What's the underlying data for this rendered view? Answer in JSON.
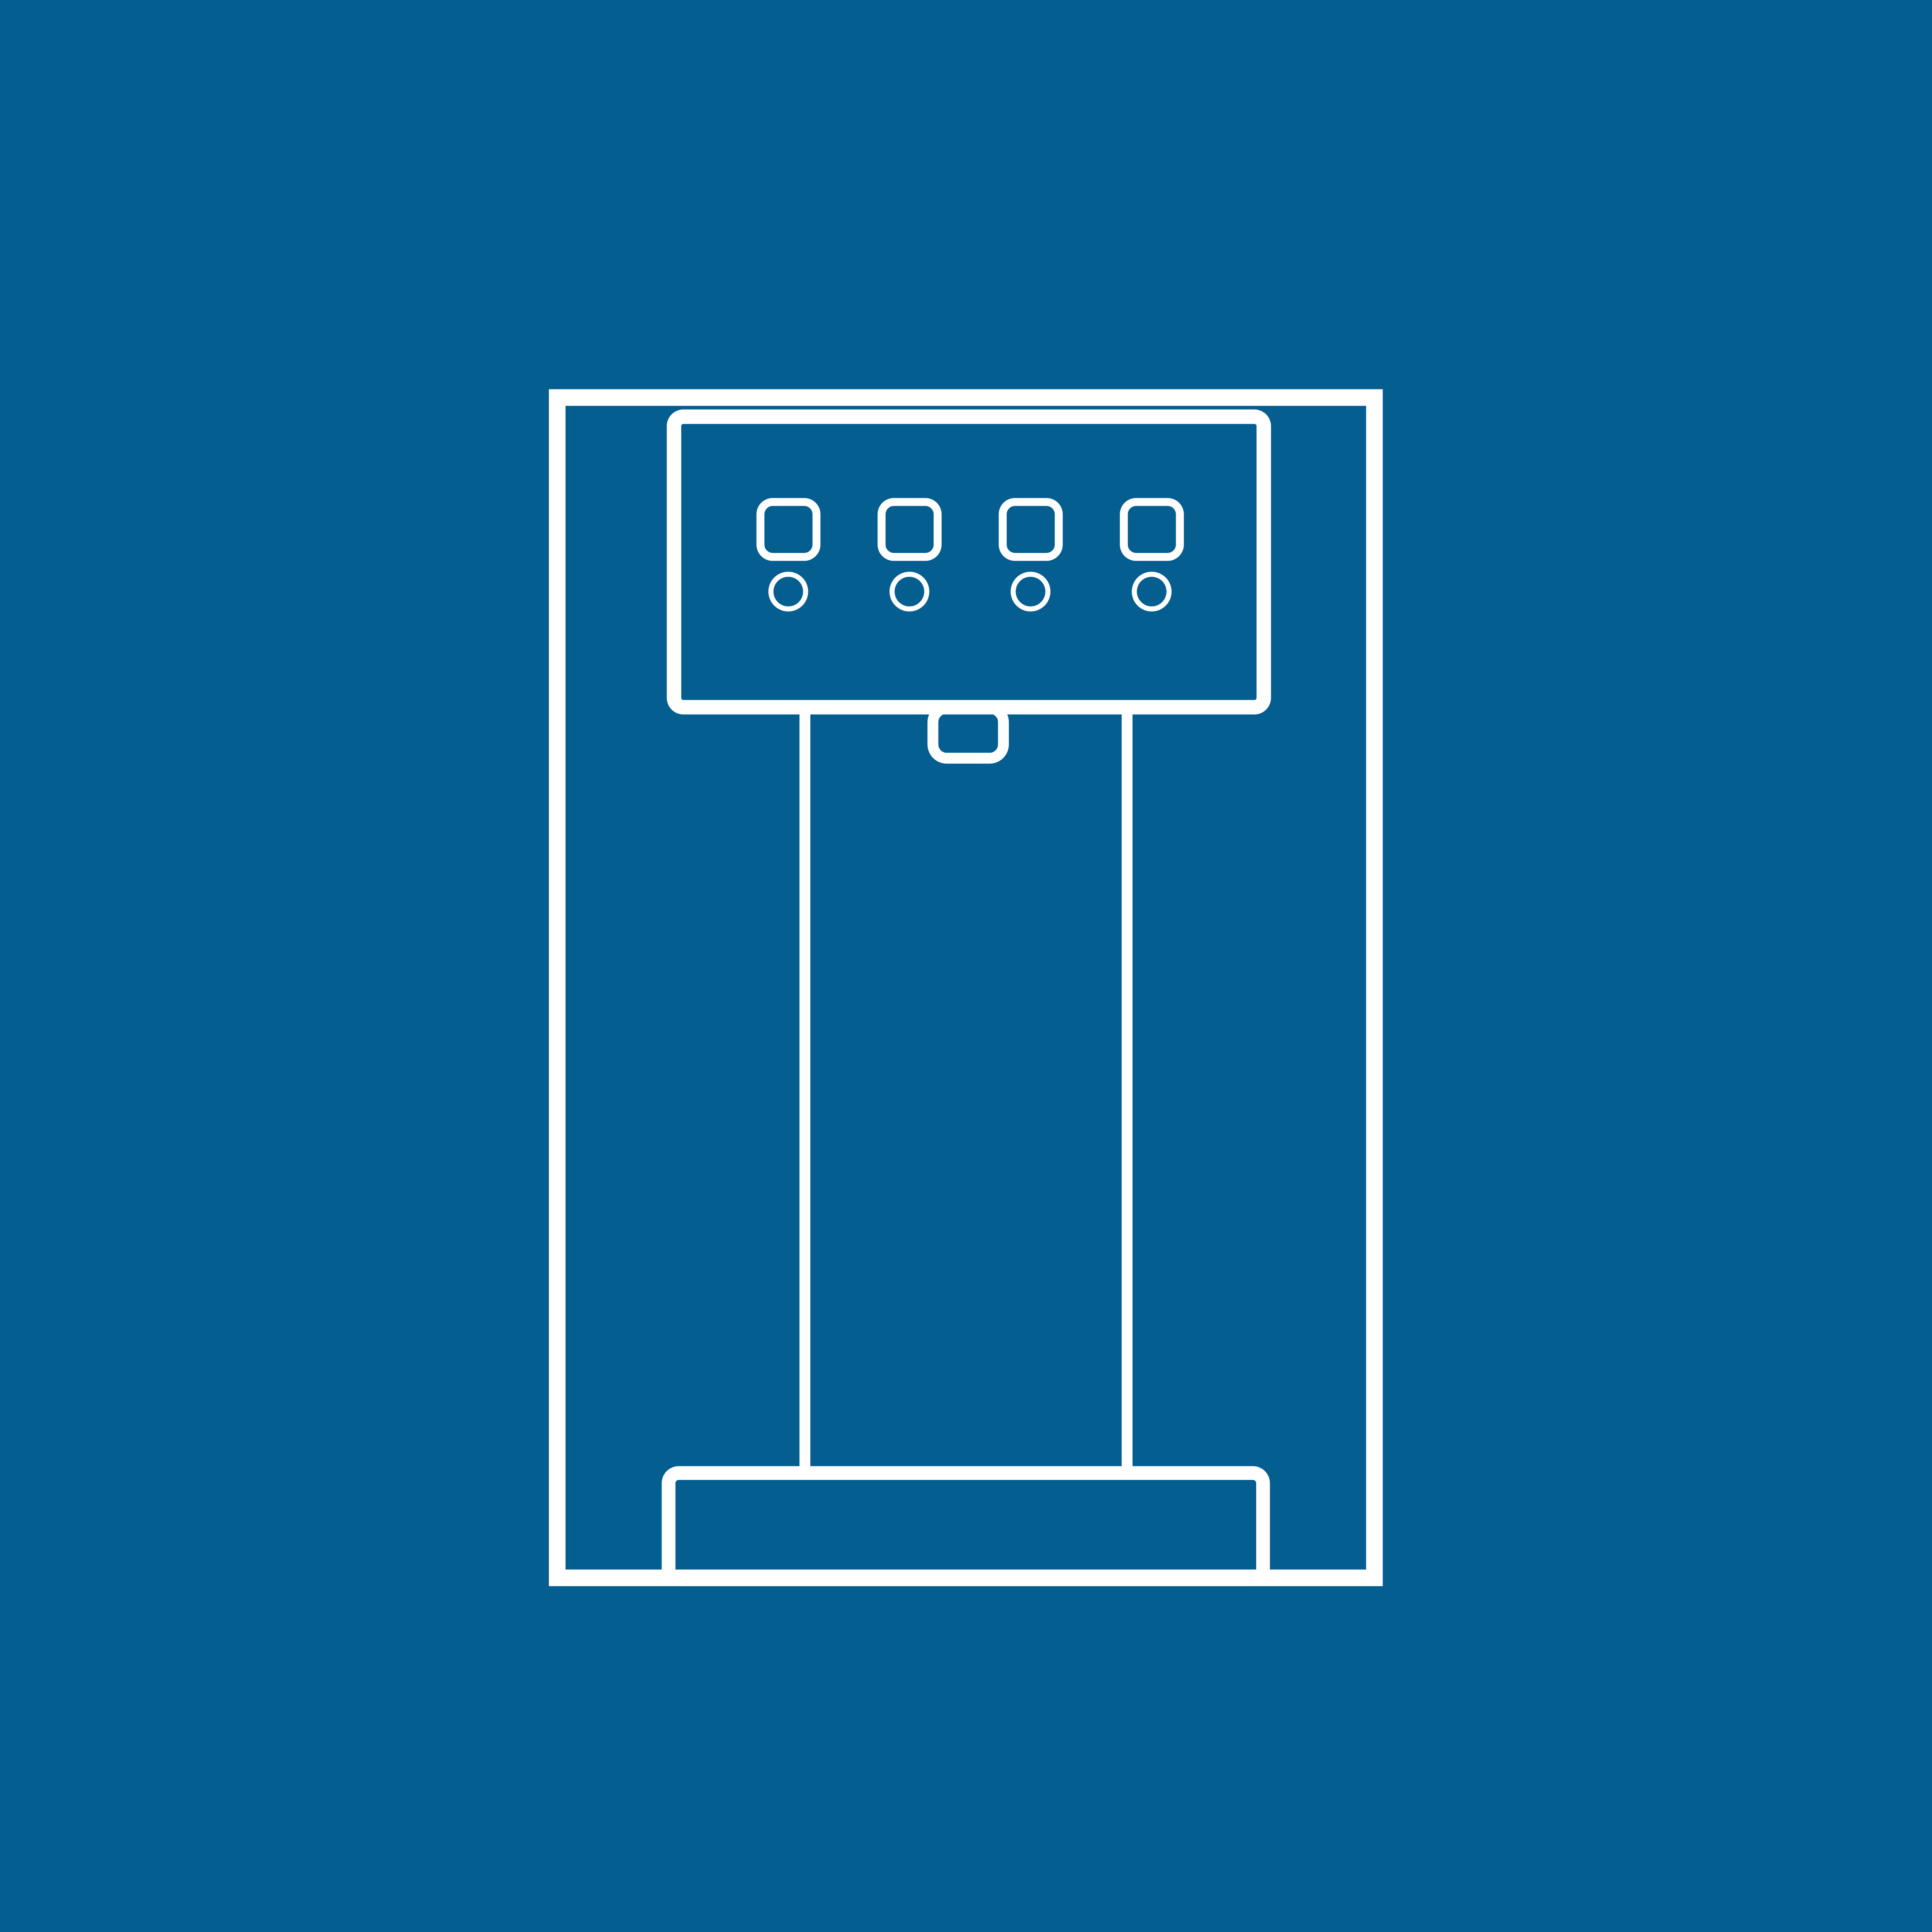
{
  "window": {
    "title": "Water Dispenser Icon"
  },
  "colors": {
    "background": "#055E90",
    "stroke": "#FFFFFF"
  },
  "icon": {
    "name": "water-dispenser-icon",
    "description": "White outline pictogram of a countertop water dispenser: control panel with four buttons and four indicator lights, spout, dispensing column and drip tray, on a solid blue background",
    "button_count": 4,
    "indicator_light_count": 4
  }
}
